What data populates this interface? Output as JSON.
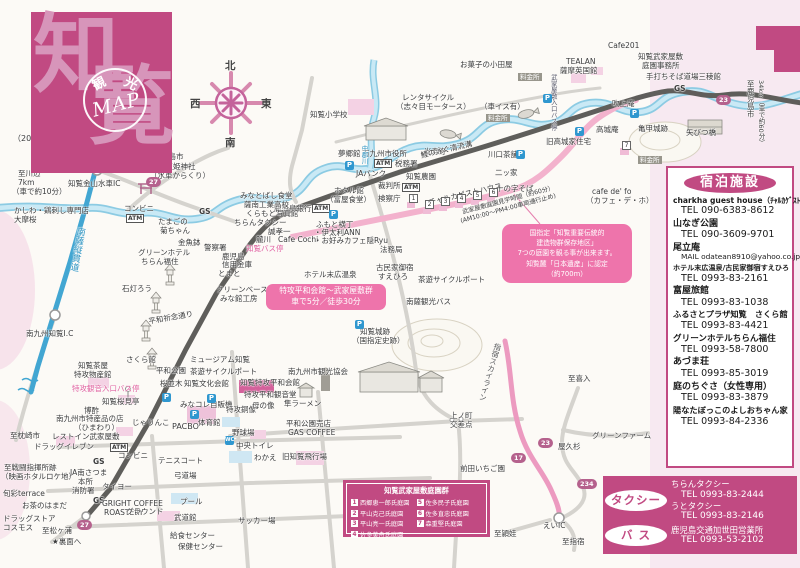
{
  "title_block": {
    "char1": "知",
    "char2": "覧",
    "stamp_top1": "観",
    "stamp_top2": "光",
    "stamp_main": "MAP"
  },
  "compass": {
    "n": "北",
    "s": "南",
    "e": "東",
    "w": "西"
  },
  "accommodations": {
    "title": "宿泊施設",
    "items": [
      {
        "name": "charkha guest house（ﾁｬﾙｶｹﾞｽﾄﾊｳｽ）",
        "fs": 7.6,
        "contact": "TEL 090-6383-8612"
      },
      {
        "name": "山なぎ公園",
        "contact": "TEL 090-3609-9701"
      },
      {
        "name": "尾立庵",
        "contact": "MAIL odatean8910@yahoo.co.jp",
        "contact_fs": 7.4
      },
      {
        "name": "ホテル末広温泉/古民家御宿すえひろ",
        "fs": 7.1,
        "contact": "TEL 0993-83-2161"
      },
      {
        "name": "富屋旅館",
        "contact": "TEL 0993-83-1038"
      },
      {
        "name": "ふるさとプラザ知覧　さくら館",
        "fs": 8.2,
        "contact": "TEL 0993-83-4421"
      },
      {
        "name": "グリーンホテルちらん福住",
        "fs": 8.6,
        "contact": "TEL 0993-58-7800"
      },
      {
        "name": "あづま荘",
        "contact": "TEL 0993-85-3019"
      },
      {
        "name": "庭のちぐさ（女性専用）",
        "contact": "TEL 0993-83-3879"
      },
      {
        "name": "陽なたぼっこのよしおちゃん家",
        "fs": 8.2,
        "contact": "TEL 0993-84-2336"
      }
    ]
  },
  "transport": {
    "taxi_label": "タクシー",
    "taxi_entries": [
      {
        "name": "ちらんタクシー",
        "tel": "TEL 0993-83-2444"
      },
      {
        "name": "うとタクシー",
        "tel": "TEL 0993-83-2146"
      }
    ],
    "bus_label": "バ ス",
    "bus_entries": [
      {
        "name": "鹿児島交通加世田営業所",
        "tel": "TEL 0993-53-2102"
      }
    ]
  },
  "legend": {
    "title": "知覧武家屋敷庭園群",
    "col1": [
      {
        "num": "1",
        "name": "西郷恵一郎氏庭園"
      },
      {
        "num": "2",
        "name": "平山克己氏庭園"
      },
      {
        "num": "3",
        "name": "平山亮一氏庭園"
      },
      {
        "num": "4",
        "name": "佐多美舟氏庭園"
      }
    ],
    "col2": [
      {
        "num": "5",
        "name": "佐多民子氏庭園"
      },
      {
        "num": "6",
        "name": "佐多直忠氏庭園"
      },
      {
        "num": "7",
        "name": "森重堅氏庭園"
      }
    ]
  },
  "callouts": {
    "preservation": [
      "国指定「知覧重要伝統的",
      "建造物群保存地区」",
      "7つの庭園を観る事が出来ます。",
      "知覧麓「日本遺産」に認定",
      "（約700m）"
    ],
    "peace": [
      "特攻平和会館～武家屋敷群",
      "車で5分／徒歩30分"
    ]
  },
  "route_badges": [
    {
      "n": "27",
      "x": 146,
      "y": 177
    },
    {
      "n": "23",
      "x": 716,
      "y": 95
    },
    {
      "n": "27",
      "x": 77,
      "y": 520
    },
    {
      "n": "23",
      "x": 538,
      "y": 438
    },
    {
      "n": "17",
      "x": 511,
      "y": 453
    },
    {
      "n": "234",
      "x": 577,
      "y": 479
    }
  ],
  "garden_badges": [
    {
      "n": "1",
      "x": 409,
      "y": 194
    },
    {
      "n": "2",
      "x": 425,
      "y": 200
    },
    {
      "n": "3",
      "x": 441,
      "y": 197
    },
    {
      "n": "4",
      "x": 457,
      "y": 194
    },
    {
      "n": "5",
      "x": 473,
      "y": 191
    },
    {
      "n": "6",
      "x": 489,
      "y": 188
    },
    {
      "n": "7",
      "x": 622,
      "y": 141
    }
  ],
  "parking_glyph": "P",
  "wc_glyph": "WC",
  "parking_icons": [
    {
      "x": 345,
      "y": 161
    },
    {
      "x": 329,
      "y": 210
    },
    {
      "x": 543,
      "y": 94
    },
    {
      "x": 630,
      "y": 109
    },
    {
      "x": 575,
      "y": 127
    },
    {
      "x": 516,
      "y": 150
    },
    {
      "x": 162,
      "y": 393
    },
    {
      "x": 207,
      "y": 394
    },
    {
      "x": 190,
      "y": 410
    },
    {
      "x": 355,
      "y": 320
    }
  ],
  "wc_icons": [
    {
      "x": 225,
      "y": 436
    }
  ],
  "map_labels": [
    {
      "t": "（2024年7月1日現在）",
      "x": 13,
      "y": 135,
      "fs": 8
    },
    {
      "t": "南九州川辺ICへ",
      "x": 60,
      "y": 142
    },
    {
      "t": "至鹿児島市",
      "x": 146,
      "y": 153
    },
    {
      "t": "裏面へ",
      "x": 115,
      "y": 154
    },
    {
      "t": "★",
      "x": 125,
      "y": 162,
      "c": "#999",
      "fs": 9
    },
    {
      "t": "至川辺",
      "x": 18,
      "y": 170
    },
    {
      "t": "7km",
      "x": 18,
      "y": 179
    },
    {
      "t": "（車で約10分）",
      "x": 12,
      "y": 188
    },
    {
      "t": "知覧金山水車IC",
      "x": 68,
      "y": 180
    },
    {
      "t": "豊玉姫神社",
      "x": 158,
      "y": 163
    },
    {
      "t": "（水車からくり）",
      "x": 150,
      "y": 172
    },
    {
      "t": "かしわ・鶏刺し専門店",
      "x": 14,
      "y": 207
    },
    {
      "t": "大摩桜",
      "x": 14,
      "y": 216
    },
    {
      "t": "南薩縦貫道",
      "x": 75,
      "y": 226,
      "v": 1,
      "c": "#2d93c0",
      "fs": 9,
      "rot": 10
    },
    {
      "t": "南九州知覧I.C",
      "x": 26,
      "y": 330
    },
    {
      "t": "至枕崎市",
      "x": 10,
      "y": 432
    },
    {
      "t": "コンビニ",
      "x": 124,
      "y": 205
    },
    {
      "t": "ATM",
      "x": 126,
      "y": 214,
      "s": "atm"
    },
    {
      "t": "たまごの",
      "x": 158,
      "y": 218
    },
    {
      "t": "菊ちゃん",
      "x": 160,
      "y": 227
    },
    {
      "t": "金魚鉢",
      "x": 178,
      "y": 239
    },
    {
      "t": "グリーンホテル",
      "x": 138,
      "y": 249
    },
    {
      "t": "ちらん福住",
      "x": 141,
      "y": 258
    },
    {
      "t": "石灯ろう",
      "x": 122,
      "y": 285
    },
    {
      "t": "GS",
      "x": 199,
      "y": 208,
      "b": 1
    },
    {
      "t": "ちらんタクシー",
      "x": 234,
      "y": 219
    },
    {
      "t": "鹿児島銀行",
      "x": 274,
      "y": 205
    },
    {
      "t": "ATM",
      "x": 312,
      "y": 204,
      "s": "atm"
    },
    {
      "t": "誠孝一",
      "x": 268,
      "y": 228
    },
    {
      "t": "麓川",
      "x": 256,
      "y": 236
    },
    {
      "t": "Cafe Cochi",
      "x": 278,
      "y": 236
    },
    {
      "t": "知覧バス停",
      "x": 246,
      "y": 245,
      "c": "#e0609e"
    },
    {
      "t": "ふもと横丁",
      "x": 316,
      "y": 221
    },
    {
      "t": "・伊太利ANN",
      "x": 314,
      "y": 229
    },
    {
      "t": "・お好みカフェ隠Ryu",
      "x": 314,
      "y": 237
    },
    {
      "t": "警察署",
      "x": 204,
      "y": 244
    },
    {
      "t": "鹿児島",
      "x": 222,
      "y": 253
    },
    {
      "t": "信用金庫",
      "x": 222,
      "y": 261
    },
    {
      "t": "とまと",
      "x": 218,
      "y": 270
    },
    {
      "t": "クリーンベース",
      "x": 216,
      "y": 286
    },
    {
      "t": "みな館工房",
      "x": 220,
      "y": 295
    },
    {
      "t": "平和祈念通り",
      "x": 148,
      "y": 318,
      "rot": -10
    },
    {
      "t": "みなとばし食堂",
      "x": 240,
      "y": 192
    },
    {
      "t": "薩南工業高校",
      "x": 244,
      "y": 201
    },
    {
      "t": "くらもと写真館",
      "x": 246,
      "y": 210
    },
    {
      "t": "知覧小学校",
      "x": 310,
      "y": 111
    },
    {
      "t": "レンタサイクル",
      "x": 402,
      "y": 94
    },
    {
      "t": "（志々目モータース）",
      "x": 396,
      "y": 103
    },
    {
      "t": "夢郷館",
      "x": 338,
      "y": 150
    },
    {
      "t": "南九州市役所",
      "x": 362,
      "y": 150
    },
    {
      "t": "ATM",
      "x": 374,
      "y": 159,
      "s": "atm"
    },
    {
      "t": "税務署",
      "x": 395,
      "y": 160
    },
    {
      "t": "JAバンク",
      "x": 356,
      "y": 170
    },
    {
      "t": "知覧農園",
      "x": 406,
      "y": 173
    },
    {
      "t": "裁判所",
      "x": 378,
      "y": 182
    },
    {
      "t": "ATM",
      "x": 402,
      "y": 183,
      "s": "atm"
    },
    {
      "t": "検察庁",
      "x": 378,
      "y": 195
    },
    {
      "t": "ホタル館",
      "x": 334,
      "y": 187
    },
    {
      "t": "（富屋食堂）",
      "x": 326,
      "y": 196
    },
    {
      "t": "光寿寺",
      "x": 424,
      "y": 148
    },
    {
      "t": "中郡川",
      "x": 360,
      "y": 145,
      "v": 1,
      "c": "#2d93c0",
      "fs": 6.5
    },
    {
      "t": "鯉の泳ぐ清流溝",
      "x": 420,
      "y": 152,
      "rot": -13
    },
    {
      "t": "チャルカゲストハウス",
      "x": 428,
      "y": 199,
      "rot": -13
    },
    {
      "t": "武家屋敷庭園見学時間（約60分）",
      "x": 462,
      "y": 210,
      "rot": -15,
      "fs": 6.2
    },
    {
      "t": "(AM10:00～PM4:00車両通行止め)",
      "x": 460,
      "y": 219,
      "rot": -15,
      "fs": 6.2
    },
    {
      "t": "法務局",
      "x": 380,
      "y": 246
    },
    {
      "t": "ホテル末広温泉",
      "x": 304,
      "y": 271
    },
    {
      "t": "古民家御宿",
      "x": 376,
      "y": 264
    },
    {
      "t": "すえひろ",
      "x": 378,
      "y": 273
    },
    {
      "t": "茶遊サイクルポート",
      "x": 418,
      "y": 276
    },
    {
      "t": "南薩観光バス",
      "x": 406,
      "y": 298
    },
    {
      "t": "知覧城跡",
      "x": 360,
      "y": 328
    },
    {
      "t": "（国指定史跡）",
      "x": 352,
      "y": 337
    },
    {
      "t": "お菓子の小田屋",
      "x": 460,
      "y": 61
    },
    {
      "t": "料金所",
      "x": 518,
      "y": 73,
      "s": "toll"
    },
    {
      "t": "（車イス有）",
      "x": 480,
      "y": 103
    },
    {
      "t": "料金所",
      "x": 486,
      "y": 114,
      "s": "toll"
    },
    {
      "t": "料金所",
      "x": 638,
      "y": 156,
      "s": "toll"
    },
    {
      "t": "武家屋敷入口バス停",
      "x": 549,
      "y": 74,
      "v": 1,
      "fs": 6.3,
      "c": "#555566"
    },
    {
      "t": "TEALAN",
      "x": 566,
      "y": 58
    },
    {
      "t": "薩摩英国館",
      "x": 560,
      "y": 67
    },
    {
      "t": "Cafe201",
      "x": 608,
      "y": 42
    },
    {
      "t": "知覧武家屋敷",
      "x": 638,
      "y": 53
    },
    {
      "t": "庭園事務所",
      "x": 642,
      "y": 62
    },
    {
      "t": "手打ちそば道場三稜館",
      "x": 646,
      "y": 73
    },
    {
      "t": "GS",
      "x": 674,
      "y": 85,
      "b": 1
    },
    {
      "t": "吹上庵",
      "x": 612,
      "y": 100
    },
    {
      "t": "高城庵",
      "x": 596,
      "y": 126
    },
    {
      "t": "旧高城家住宅",
      "x": 546,
      "y": 138
    },
    {
      "t": "亀甲城跡",
      "x": 638,
      "y": 125
    },
    {
      "t": "矢びつ橋",
      "x": 686,
      "y": 129
    },
    {
      "t": "川口茶舗",
      "x": 488,
      "y": 151
    },
    {
      "t": "二ッ家",
      "x": 495,
      "y": 169
    },
    {
      "t": "十の字そば",
      "x": 496,
      "y": 185
    },
    {
      "t": "cafe de' fo",
      "x": 592,
      "y": 188
    },
    {
      "t": "（カフェ・デ・ホ）",
      "x": 586,
      "y": 197
    },
    {
      "t": "至鹿児島市",
      "x": 746,
      "y": 80,
      "v": 1,
      "fs": 7.5
    },
    {
      "t": "34km（車で約60分）",
      "x": 757,
      "y": 80,
      "v": 1,
      "fs": 6.5
    },
    {
      "t": "さくら館",
      "x": 126,
      "y": 356
    },
    {
      "t": "知覧茶屋",
      "x": 78,
      "y": 362
    },
    {
      "t": "特攻物産館",
      "x": 74,
      "y": 371
    },
    {
      "t": "特攻観音入口バス停",
      "x": 72,
      "y": 385,
      "c": "#e0609e"
    },
    {
      "t": "知覧桜見亭",
      "x": 102,
      "y": 398
    },
    {
      "t": "博酢",
      "x": 84,
      "y": 407
    },
    {
      "t": "南九州市特産品の店",
      "x": 56,
      "y": 415
    },
    {
      "t": "（ひまわり）",
      "x": 74,
      "y": 424
    },
    {
      "t": "じゃりんこ",
      "x": 132,
      "y": 419
    },
    {
      "t": "レストイン武家屋敷",
      "x": 52,
      "y": 433
    },
    {
      "t": "ドラッグイレブン",
      "x": 34,
      "y": 443
    },
    {
      "t": "ATM",
      "x": 110,
      "y": 443,
      "s": "atm"
    },
    {
      "t": "コンビニ",
      "x": 118,
      "y": 452
    },
    {
      "t": "GS",
      "x": 93,
      "y": 458,
      "b": 1
    },
    {
      "t": "至戦闘指揮所跡",
      "x": 4,
      "y": 464
    },
    {
      "t": "（映画ホタルロケ地）",
      "x": 1,
      "y": 473
    },
    {
      "t": "JA南さつま",
      "x": 70,
      "y": 469
    },
    {
      "t": "本所",
      "x": 78,
      "y": 478
    },
    {
      "t": "タイヨー",
      "x": 102,
      "y": 483
    },
    {
      "t": "消防署",
      "x": 72,
      "y": 487
    },
    {
      "t": "旬彩terrace",
      "x": 3,
      "y": 490
    },
    {
      "t": "GS",
      "x": 93,
      "y": 497,
      "b": 1
    },
    {
      "t": "お茶のはまだ",
      "x": 22,
      "y": 502
    },
    {
      "t": "GRIGHT COFFEE",
      "x": 102,
      "y": 500
    },
    {
      "t": "ROASTERY",
      "x": 104,
      "y": 509
    },
    {
      "t": "ドラッグストア",
      "x": 3,
      "y": 515
    },
    {
      "t": "コスモス",
      "x": 3,
      "y": 524
    },
    {
      "t": "至松ヶ浦",
      "x": 42,
      "y": 527
    },
    {
      "t": "★裏面へ",
      "x": 52,
      "y": 538
    },
    {
      "t": "平和公園",
      "x": 156,
      "y": 367
    },
    {
      "t": "茶遊サイクルポート",
      "x": 190,
      "y": 368
    },
    {
      "t": "桜並木",
      "x": 160,
      "y": 380
    },
    {
      "t": "知覧文化会館",
      "x": 184,
      "y": 380
    },
    {
      "t": "ミュージアム知覧",
      "x": 190,
      "y": 356
    },
    {
      "t": "みなコレ自販機",
      "x": 180,
      "y": 401
    },
    {
      "t": "PACBO",
      "x": 172,
      "y": 423,
      "fs": 8
    },
    {
      "t": "体育館",
      "x": 198,
      "y": 419
    },
    {
      "t": "テニスコート",
      "x": 158,
      "y": 457
    },
    {
      "t": "弓道場",
      "x": 174,
      "y": 472
    },
    {
      "t": "グラウンド",
      "x": 126,
      "y": 508
    },
    {
      "t": "サッカー場",
      "x": 238,
      "y": 517
    },
    {
      "t": "プール",
      "x": 180,
      "y": 498
    },
    {
      "t": "武道館",
      "x": 174,
      "y": 514
    },
    {
      "t": "給食センター",
      "x": 170,
      "y": 532
    },
    {
      "t": "保健センター",
      "x": 178,
      "y": 543
    },
    {
      "t": "知覧特攻平和会館",
      "x": 240,
      "y": 379
    },
    {
      "t": "特攻平和観音堂",
      "x": 244,
      "y": 391
    },
    {
      "t": "特攻銅像",
      "x": 226,
      "y": 406
    },
    {
      "t": "母の像",
      "x": 252,
      "y": 402
    },
    {
      "t": "隼ラーメン",
      "x": 284,
      "y": 400
    },
    {
      "t": "南九州市観光協会",
      "x": 288,
      "y": 368
    },
    {
      "t": "平和公園売店",
      "x": 286,
      "y": 420
    },
    {
      "t": "GAS COFFEE",
      "x": 288,
      "y": 429
    },
    {
      "t": "野球場",
      "x": 232,
      "y": 429
    },
    {
      "t": "中央トイレ",
      "x": 236,
      "y": 442
    },
    {
      "t": "わかえ",
      "x": 254,
      "y": 454
    },
    {
      "t": "旧知覧飛行場",
      "x": 282,
      "y": 453
    },
    {
      "t": "上ノ町",
      "x": 450,
      "y": 412
    },
    {
      "t": "交差点",
      "x": 450,
      "y": 421
    },
    {
      "t": "前田いちご園",
      "x": 460,
      "y": 465
    },
    {
      "t": "至喜入",
      "x": 568,
      "y": 375
    },
    {
      "t": "グリーンファーム",
      "x": 592,
      "y": 432
    },
    {
      "t": "屋久杉",
      "x": 558,
      "y": 443
    },
    {
      "t": "至頴娃",
      "x": 494,
      "y": 530
    },
    {
      "t": "えいIC",
      "x": 543,
      "y": 522
    },
    {
      "t": "至指宿",
      "x": 562,
      "y": 538
    },
    {
      "t": "指宿スカイライン",
      "x": 494,
      "y": 342,
      "v": 1,
      "fs": 7.5,
      "rot": 16,
      "c": "#555"
    }
  ]
}
